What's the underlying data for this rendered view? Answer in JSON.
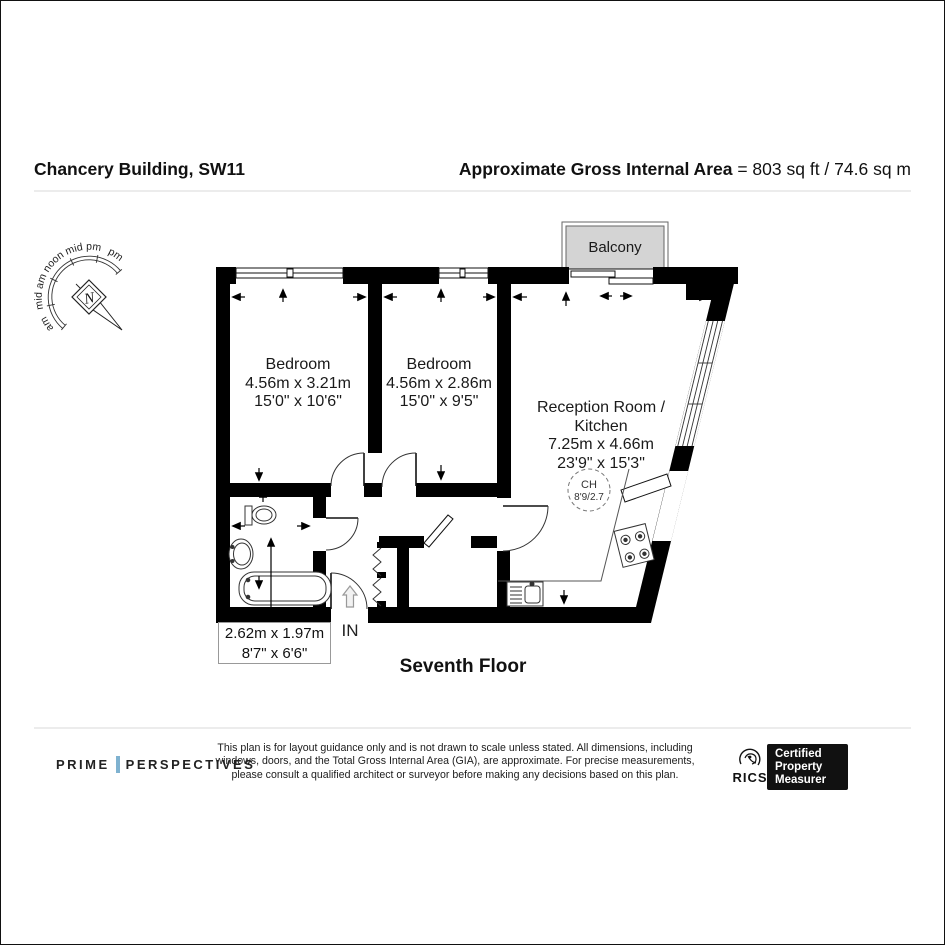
{
  "header": {
    "title": "Chancery Building, SW11",
    "area_label": "Approximate Gross Internal Area",
    "area_value": " = 803 sq ft / 74.6 sq m"
  },
  "compass": {
    "labels": [
      "am",
      "mid am",
      "noon",
      "mid pm",
      "pm"
    ],
    "north": "N"
  },
  "plan": {
    "balcony": "Balcony",
    "rooms": [
      {
        "lines": [
          "Bedroom",
          "4.56m x 3.21m",
          "15'0\" x 10'6\""
        ]
      },
      {
        "lines": [
          "Bedroom",
          "4.56m x 2.86m",
          "15'0\" x 9'5\""
        ]
      },
      {
        "lines": [
          "Reception Room /",
          "Kitchen",
          "7.25m x 4.66m",
          "23'9\" x 15'3\""
        ]
      }
    ],
    "ceiling_height": {
      "label": "CH",
      "value": "8'9/2.7"
    },
    "bathroom_box": {
      "lines": [
        "2.62m x 1.97m",
        "8'7\" x 6'6\""
      ]
    },
    "entry": "IN",
    "floor": "Seventh Floor"
  },
  "footer": {
    "brand1": "PRIME",
    "brand2": "PERSPECTIVES",
    "disclaimer": [
      "This plan is for layout guidance only and is not drawn to scale unless stated. All dimensions, including",
      "windows, doors, and the Total Gross Internal Area (GIA), are approximate. For precise measurements,",
      "please consult a qualified architect or surveyor before making any decisions based on this plan."
    ],
    "rics": "RICS",
    "badge": [
      "Certified",
      "Property",
      "Measurer"
    ]
  },
  "colors": {
    "wall": "#000000",
    "balcony_fill": "#d4d4d4",
    "accent_bar": "#7fb2d0"
  }
}
